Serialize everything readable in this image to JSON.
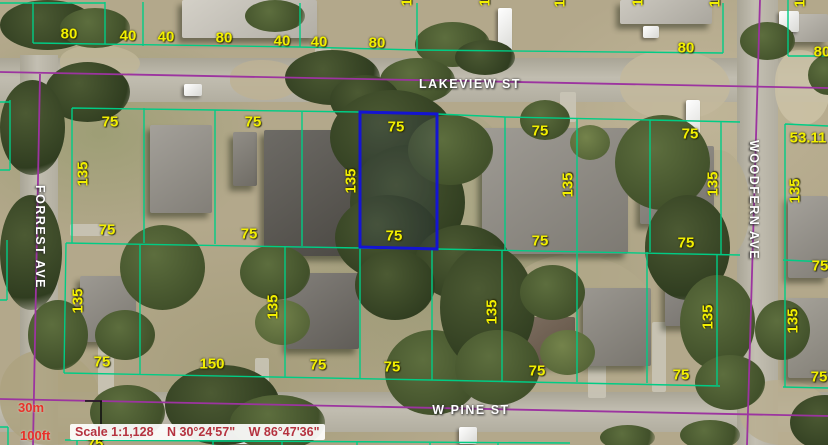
{
  "map": {
    "streets": [
      {
        "id": "lakeview",
        "name": "LAKEVIEW ST",
        "orientation": "horizontal"
      },
      {
        "id": "w-pine",
        "name": "W PINE ST",
        "orientation": "horizontal"
      },
      {
        "id": "forrest",
        "name": "FORREST AVE",
        "orientation": "vertical"
      },
      {
        "id": "woodfern",
        "name": "WOODFERN AVE",
        "orientation": "vertical"
      }
    ],
    "status_bar": {
      "scale_text": "Scale 1:1,128",
      "latitude": "N 30°24'57\"",
      "longitude": "W 86°47'36\""
    },
    "scale_bar": {
      "metric_label": "30m",
      "imperial_label": "100ft"
    },
    "highlighted_parcel": {
      "width_label": "75",
      "depth_label": "135"
    },
    "colors": {
      "parcel_line": "#00cc85",
      "road_line": "#9c34a0",
      "selected_parcel": "#1414d2",
      "dimension_text": "#f2ef00",
      "street_text": "#ffffff",
      "status_text": "#b5323f",
      "scale_bar_text": "#e8322a"
    },
    "dimension_labels": [
      {
        "t": "80",
        "x": 69,
        "y": 34
      },
      {
        "t": "40",
        "x": 128,
        "y": 36
      },
      {
        "t": "40",
        "x": 166,
        "y": 37
      },
      {
        "t": "80",
        "x": 224,
        "y": 38
      },
      {
        "t": "40",
        "x": 282,
        "y": 41
      },
      {
        "t": "40",
        "x": 319,
        "y": 42
      },
      {
        "t": "80",
        "x": 377,
        "y": 43
      },
      {
        "t": "80",
        "x": 686,
        "y": 48
      },
      {
        "t": "80",
        "x": 822,
        "y": 52
      },
      {
        "t": "135",
        "x": 407,
        "y": -6,
        "r": 1
      },
      {
        "t": "135",
        "x": 485,
        "y": -6,
        "r": 1
      },
      {
        "t": "135",
        "x": 560,
        "y": -5,
        "r": 1
      },
      {
        "t": "135",
        "x": 638,
        "y": -6,
        "r": 1
      },
      {
        "t": "135",
        "x": 715,
        "y": -5,
        "r": 1
      },
      {
        "t": "135",
        "x": 800,
        "y": -5,
        "r": 1
      },
      {
        "t": "135",
        "x": -7,
        "y": 150,
        "r": 1
      },
      {
        "t": "75",
        "x": 110,
        "y": 122
      },
      {
        "t": "75",
        "x": 253,
        "y": 122
      },
      {
        "t": "75",
        "x": 396,
        "y": 127
      },
      {
        "t": "75",
        "x": 540,
        "y": 131
      },
      {
        "t": "75",
        "x": 690,
        "y": 134
      },
      {
        "t": "53.11",
        "x": 808,
        "y": 138
      },
      {
        "t": "135",
        "x": 83,
        "y": 174,
        "r": 1
      },
      {
        "t": "135",
        "x": 351,
        "y": 181,
        "r": 1
      },
      {
        "t": "135",
        "x": 568,
        "y": 185,
        "r": 1
      },
      {
        "t": "135",
        "x": 713,
        "y": 184,
        "r": 1
      },
      {
        "t": "135",
        "x": 795,
        "y": 191,
        "r": 1
      },
      {
        "t": "75",
        "x": 107,
        "y": 230
      },
      {
        "t": "75",
        "x": 249,
        "y": 234
      },
      {
        "t": "75",
        "x": 394,
        "y": 236
      },
      {
        "t": "75",
        "x": 540,
        "y": 241
      },
      {
        "t": "75",
        "x": 686,
        "y": 243
      },
      {
        "t": "75",
        "x": 820,
        "y": 266
      },
      {
        "t": "135",
        "x": 78,
        "y": 301,
        "r": 1
      },
      {
        "t": "135",
        "x": 273,
        "y": 307,
        "r": 1
      },
      {
        "t": "135",
        "x": 492,
        "y": 312,
        "r": 1
      },
      {
        "t": "135",
        "x": 708,
        "y": 317,
        "r": 1
      },
      {
        "t": "135",
        "x": 793,
        "y": 321,
        "r": 1
      },
      {
        "t": "75",
        "x": 102,
        "y": 362
      },
      {
        "t": "150",
        "x": 212,
        "y": 364
      },
      {
        "t": "75",
        "x": 318,
        "y": 365
      },
      {
        "t": "75",
        "x": 392,
        "y": 367
      },
      {
        "t": "75",
        "x": 537,
        "y": 371
      },
      {
        "t": "75",
        "x": 681,
        "y": 375
      },
      {
        "t": "75",
        "x": 819,
        "y": 377
      },
      {
        "t": "75",
        "x": 95,
        "y": 444
      }
    ]
  },
  "scenery": {
    "roads": [
      {
        "x": 0,
        "y": 58,
        "w": 828,
        "h": 44,
        "v": 0
      },
      {
        "x": 0,
        "y": 392,
        "w": 828,
        "h": 40,
        "v": 0
      },
      {
        "x": 20,
        "y": 55,
        "w": 38,
        "h": 390,
        "v": 1
      },
      {
        "x": 737,
        "y": 0,
        "w": 41,
        "h": 445,
        "v": 1
      }
    ],
    "patches": [
      [
        430,
        115,
        80,
        135,
        "#aca786"
      ],
      [
        500,
        255,
        160,
        135,
        "#b2a88a"
      ],
      [
        620,
        50,
        110,
        70,
        "#c3b99c"
      ],
      [
        775,
        50,
        55,
        75,
        "#cbc2a6"
      ],
      [
        60,
        45,
        80,
        35,
        "#c0b698"
      ],
      [
        540,
        160,
        90,
        100,
        "#b0a88a"
      ],
      [
        690,
        150,
        60,
        110,
        "#b5ab8d"
      ],
      [
        230,
        60,
        70,
        40,
        "#bdb294"
      ],
      [
        740,
        380,
        90,
        65,
        "#b8ae90"
      ],
      [
        0,
        350,
        100,
        95,
        "#ada27f"
      ]
    ],
    "paving": [
      [
        315,
        48,
        16,
        50
      ],
      [
        560,
        92,
        16,
        30
      ],
      [
        98,
        335,
        16,
        60
      ],
      [
        588,
        352,
        18,
        46
      ],
      [
        652,
        322,
        14,
        70
      ],
      [
        70,
        224,
        45,
        12
      ],
      [
        255,
        358,
        14,
        36
      ],
      [
        805,
        330,
        23,
        12
      ]
    ],
    "houses": [
      [
        182,
        0,
        135,
        38,
        "#cdc9bf"
      ],
      [
        620,
        0,
        92,
        24,
        "#c4c0b6"
      ],
      [
        793,
        14,
        35,
        28,
        "#b7b3a9"
      ],
      [
        150,
        125,
        62,
        88,
        "#96928a"
      ],
      [
        233,
        132,
        24,
        54,
        "#807c74"
      ],
      [
        264,
        130,
        92,
        126,
        "#57544e"
      ],
      [
        482,
        128,
        146,
        126,
        "#908c84"
      ],
      [
        640,
        146,
        74,
        78,
        "#88847c"
      ],
      [
        788,
        196,
        40,
        82,
        "#97938b"
      ],
      [
        80,
        276,
        56,
        66,
        "#8e8a82"
      ],
      [
        287,
        273,
        72,
        76,
        "#6f6b65"
      ],
      [
        507,
        317,
        68,
        48,
        "#6d5c4c"
      ],
      [
        583,
        288,
        68,
        78,
        "#8b877f"
      ],
      [
        665,
        258,
        56,
        68,
        "#85817b"
      ],
      [
        788,
        298,
        42,
        80,
        "#98948a"
      ]
    ],
    "vehicles": [
      [
        322,
        56,
        13,
        19
      ],
      [
        498,
        8,
        14,
        46
      ],
      [
        643,
        26,
        16,
        12
      ],
      [
        184,
        84,
        18,
        12
      ],
      [
        686,
        100,
        14,
        42
      ],
      [
        225,
        428,
        33,
        16
      ],
      [
        459,
        427,
        18,
        17
      ],
      [
        779,
        11,
        20,
        21
      ]
    ],
    "trees": [
      [
        0,
        0,
        95,
        50,
        0
      ],
      [
        60,
        8,
        70,
        40,
        1
      ],
      [
        245,
        0,
        60,
        32,
        1
      ],
      [
        415,
        22,
        75,
        45,
        1
      ],
      [
        455,
        40,
        60,
        35,
        0
      ],
      [
        740,
        22,
        55,
        38,
        1
      ],
      [
        45,
        62,
        85,
        60,
        0
      ],
      [
        0,
        80,
        65,
        95,
        0
      ],
      [
        285,
        50,
        95,
        55,
        0
      ],
      [
        380,
        58,
        75,
        45,
        1
      ],
      [
        330,
        75,
        70,
        50,
        0
      ],
      [
        0,
        195,
        62,
        115,
        0
      ],
      [
        28,
        300,
        60,
        70,
        1
      ],
      [
        120,
        225,
        85,
        85,
        1
      ],
      [
        95,
        310,
        60,
        50,
        1
      ],
      [
        330,
        90,
        125,
        95,
        0
      ],
      [
        350,
        145,
        115,
        115,
        0
      ],
      [
        335,
        195,
        105,
        85,
        0
      ],
      [
        408,
        115,
        85,
        70,
        1
      ],
      [
        415,
        225,
        95,
        75,
        0
      ],
      [
        355,
        250,
        80,
        70,
        0
      ],
      [
        385,
        330,
        95,
        85,
        1
      ],
      [
        440,
        245,
        95,
        125,
        0
      ],
      [
        455,
        330,
        85,
        75,
        1
      ],
      [
        240,
        245,
        70,
        55,
        1
      ],
      [
        255,
        300,
        55,
        45,
        2
      ],
      [
        520,
        265,
        65,
        55,
        1
      ],
      [
        540,
        330,
        55,
        45,
        2
      ],
      [
        615,
        115,
        95,
        95,
        1
      ],
      [
        645,
        195,
        85,
        105,
        0
      ],
      [
        680,
        275,
        75,
        95,
        1
      ],
      [
        695,
        355,
        70,
        55,
        1
      ],
      [
        755,
        300,
        55,
        60,
        1
      ],
      [
        790,
        395,
        70,
        55,
        0
      ],
      [
        808,
        55,
        40,
        40,
        1
      ],
      [
        165,
        365,
        115,
        80,
        0
      ],
      [
        230,
        395,
        95,
        55,
        1
      ],
      [
        90,
        385,
        75,
        55,
        1
      ],
      [
        600,
        425,
        55,
        25,
        1
      ],
      [
        680,
        420,
        60,
        30,
        1
      ],
      [
        520,
        100,
        50,
        40,
        1
      ],
      [
        570,
        125,
        40,
        35,
        2
      ]
    ]
  }
}
